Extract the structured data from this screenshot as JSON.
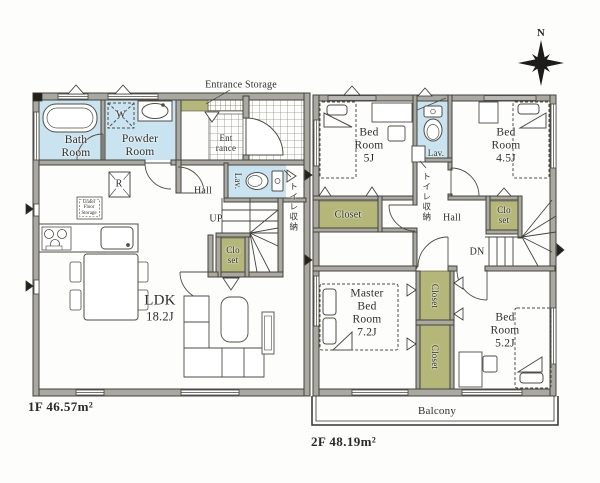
{
  "compass": {
    "north": "N"
  },
  "floor1": {
    "area": "1F 46.57m²",
    "labels": {
      "bath": "Bath\nRoom",
      "powder": "Powder\nRoom",
      "washer": "W",
      "entrance_storage": "Entrance Storage",
      "entrance": "Ent\nrance",
      "hall": "Hall",
      "up": "UP",
      "lav": "Lav.",
      "toilet_storage": "トイレ収納",
      "closet": "Clo\nset",
      "under_floor_storage": "Under\nFloor\nStorage",
      "fridge": "R",
      "ldk": "LDK",
      "ldk_size": "18.2J"
    }
  },
  "floor2": {
    "area": "2F 48.19m²",
    "labels": {
      "bed5": "Bed\nRoom\n5J",
      "lav": "Lav.",
      "bed45": "Bed\nRoom\n4.5J",
      "closet5": "Closet",
      "toilet_storage": "トイレ収納",
      "hall": "Hall",
      "closet45": "Clo\nset",
      "dn": "DN",
      "master": "Master\nBed\nRoom\n7.2J",
      "closet_m1": "Closet",
      "closet_m2": "Closet",
      "bed52": "Bed\nRoom\n5.2J",
      "balcony": "Balcony"
    }
  },
  "colors": {
    "wall": "#a9a8a1",
    "wall_edge": "#45433c",
    "water_room": "#c9e4f0",
    "closet": "#b4b778",
    "line": "#4f4d46",
    "text": "#2f2e29",
    "background": "#fdfdfb"
  }
}
